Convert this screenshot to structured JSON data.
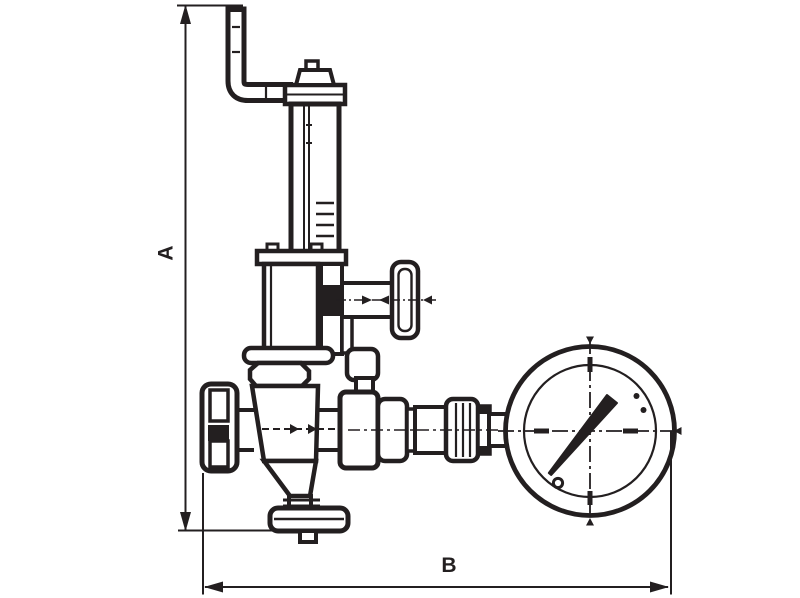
{
  "canvas": {
    "width": 800,
    "height": 598,
    "background": "#ffffff",
    "ink": "#231f20"
  },
  "diagram": {
    "type": "technical-line-drawing",
    "subject": "Pressure reducing valve with siphon pipe, side adjustment screw and pressure gauge",
    "dimensions": {
      "vertical_label": "A",
      "horizontal_label": "B"
    },
    "components": {
      "siphon_pipe": "elbow pipe at top",
      "spring_housing": "vertical cylinder tower",
      "cap": "top cap nut",
      "bonnet": "upper body box",
      "side_screw": "horizontal screw with T-handle",
      "inlet_fitting": "left knurled connection",
      "valve_body": "tapered central body with flow arrow",
      "outlet_union": "right union fittings",
      "pressure_gauge": "dial gauge with needle",
      "bottom_flange": "lower outlet flange"
    }
  }
}
